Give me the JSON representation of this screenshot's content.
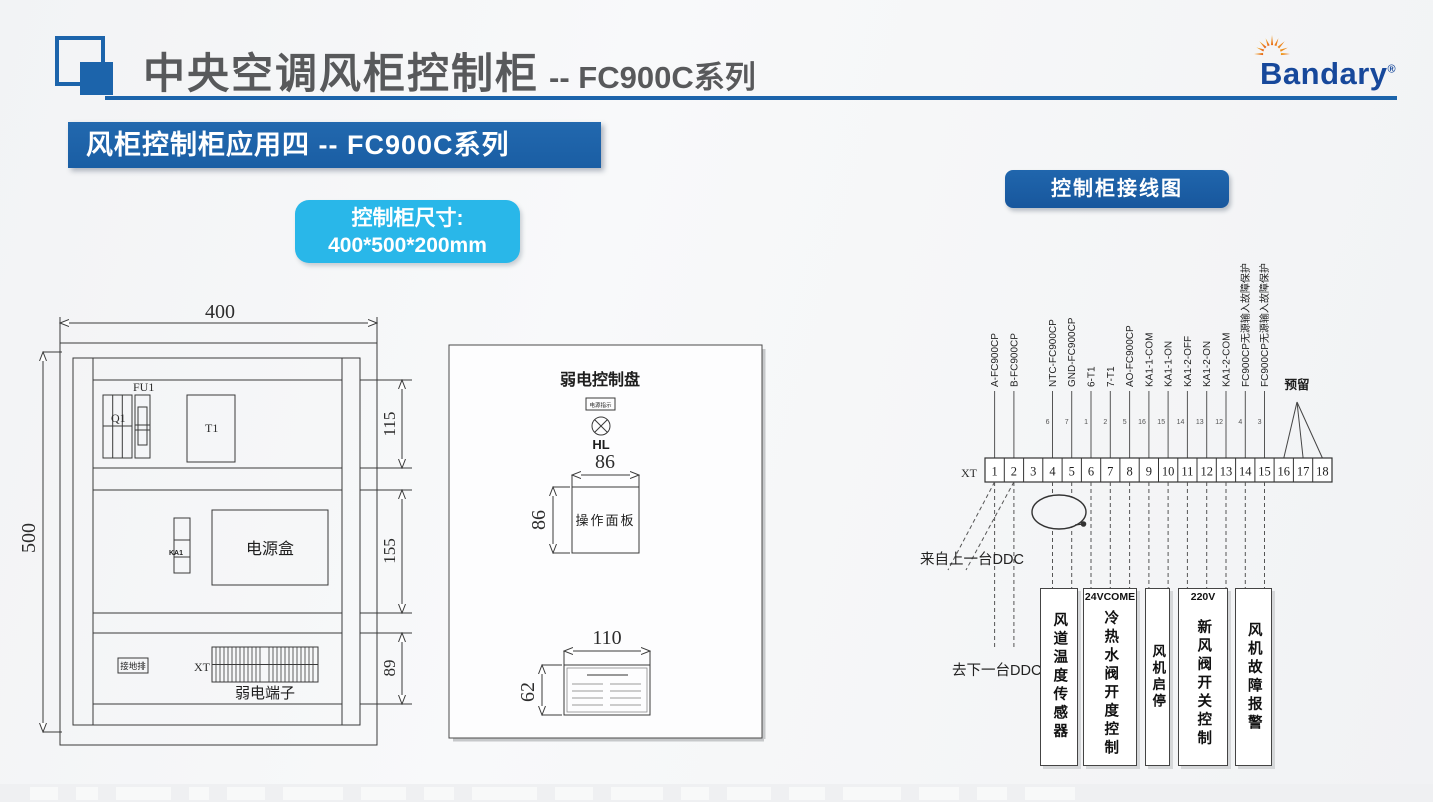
{
  "colors": {
    "accent": "#1c64ab",
    "banner": "#1e63a9",
    "cyan": "#29b7e9",
    "badge": "#1a67ae",
    "title": "#58595b",
    "logo": "#17489b",
    "line": "#3a3a3a"
  },
  "header": {
    "title": "中央空调风柜控制柜",
    "subtitle": "-- FC900C系列",
    "logo": "Bandary",
    "reg": "®"
  },
  "banner": {
    "text": "风柜控制柜应用四 -- FC900C系列"
  },
  "size_box": {
    "line1": "控制柜尺寸:",
    "line2": "400*500*200mm"
  },
  "cabinet": {
    "dim_width": "400",
    "dim_height": "500",
    "dim_sec1": "115",
    "dim_sec2": "155",
    "dim_sec3": "89",
    "fu1": "FU1",
    "q1": "Q1",
    "t1": "T1",
    "ka1": "KA1",
    "power_box": "电源盒",
    "ground_bar": "接地排",
    "xt": "XT",
    "weak_terminals": "弱电端子"
  },
  "panel": {
    "title": "弱电控制盘",
    "indicator": "电源指示",
    "lamp": "HL",
    "dim_top": "86",
    "dim_left": "86",
    "label": "操作面板",
    "dim_width": "110",
    "dim_height": "62"
  },
  "wiring": {
    "badge": "控制柜接线图",
    "xt": "XT",
    "terminals": [
      "1",
      "2",
      "3",
      "4",
      "5",
      "6",
      "7",
      "8",
      "9",
      "10",
      "11",
      "12",
      "13",
      "14",
      "15",
      "16",
      "17",
      "18"
    ],
    "wires": [
      {
        "terminal": "1",
        "label": "A-FC900CP",
        "tag": ""
      },
      {
        "terminal": "2",
        "label": "B-FC900CP",
        "tag": ""
      },
      {
        "terminal": "4",
        "label": "NTC-FC900CP",
        "tag": "6"
      },
      {
        "terminal": "5",
        "label": "GND-FC900CP",
        "tag": "7"
      },
      {
        "terminal": "6",
        "label": "6-T1",
        "tag": "1"
      },
      {
        "terminal": "7",
        "label": "7-T1",
        "tag": "2"
      },
      {
        "terminal": "8",
        "label": "AO-FC900CP",
        "tag": "5"
      },
      {
        "terminal": "9",
        "label": "KA1-1-COM",
        "tag": "16"
      },
      {
        "terminal": "10",
        "label": "KA1-1-ON",
        "tag": "15"
      },
      {
        "terminal": "11",
        "label": "KA1-2-OFF",
        "tag": "14"
      },
      {
        "terminal": "12",
        "label": "KA1-2-ON",
        "tag": "13"
      },
      {
        "terminal": "13",
        "label": "KA1-2-COM",
        "tag": "12"
      },
      {
        "terminal": "14",
        "label": "FC900CP无源输入故障保护",
        "tag": "4"
      },
      {
        "terminal": "15",
        "label": "FC900CP无源输入故障保护",
        "tag": "3"
      }
    ],
    "reserved": "预留",
    "from_ddc": "来自上一台DDC",
    "to_ddc": "去下一台DDC",
    "load_boxes": [
      {
        "header": "",
        "text": "风道温度传感器"
      },
      {
        "header": "24VCOME",
        "text": "冷热水阀开度控制"
      },
      {
        "header": "",
        "text": "风机启停"
      },
      {
        "header": "220V",
        "text": "新风阀开关控制"
      },
      {
        "header": "",
        "text": "风机故障报警"
      }
    ]
  }
}
